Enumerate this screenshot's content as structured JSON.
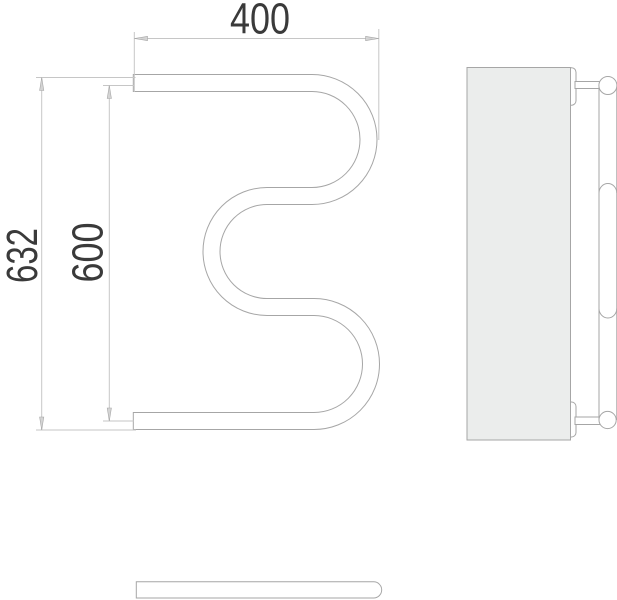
{
  "dimensions": {
    "width_top": "400",
    "height_overall": "632",
    "height_inner": "600"
  },
  "colors": {
    "line-color": "#a6a6a6",
    "dim-color": "#c6c6c6",
    "arrow-fill": "#d4d4d4",
    "text-color": "#3a3a3a",
    "panel-fill": "#ebedec"
  }
}
